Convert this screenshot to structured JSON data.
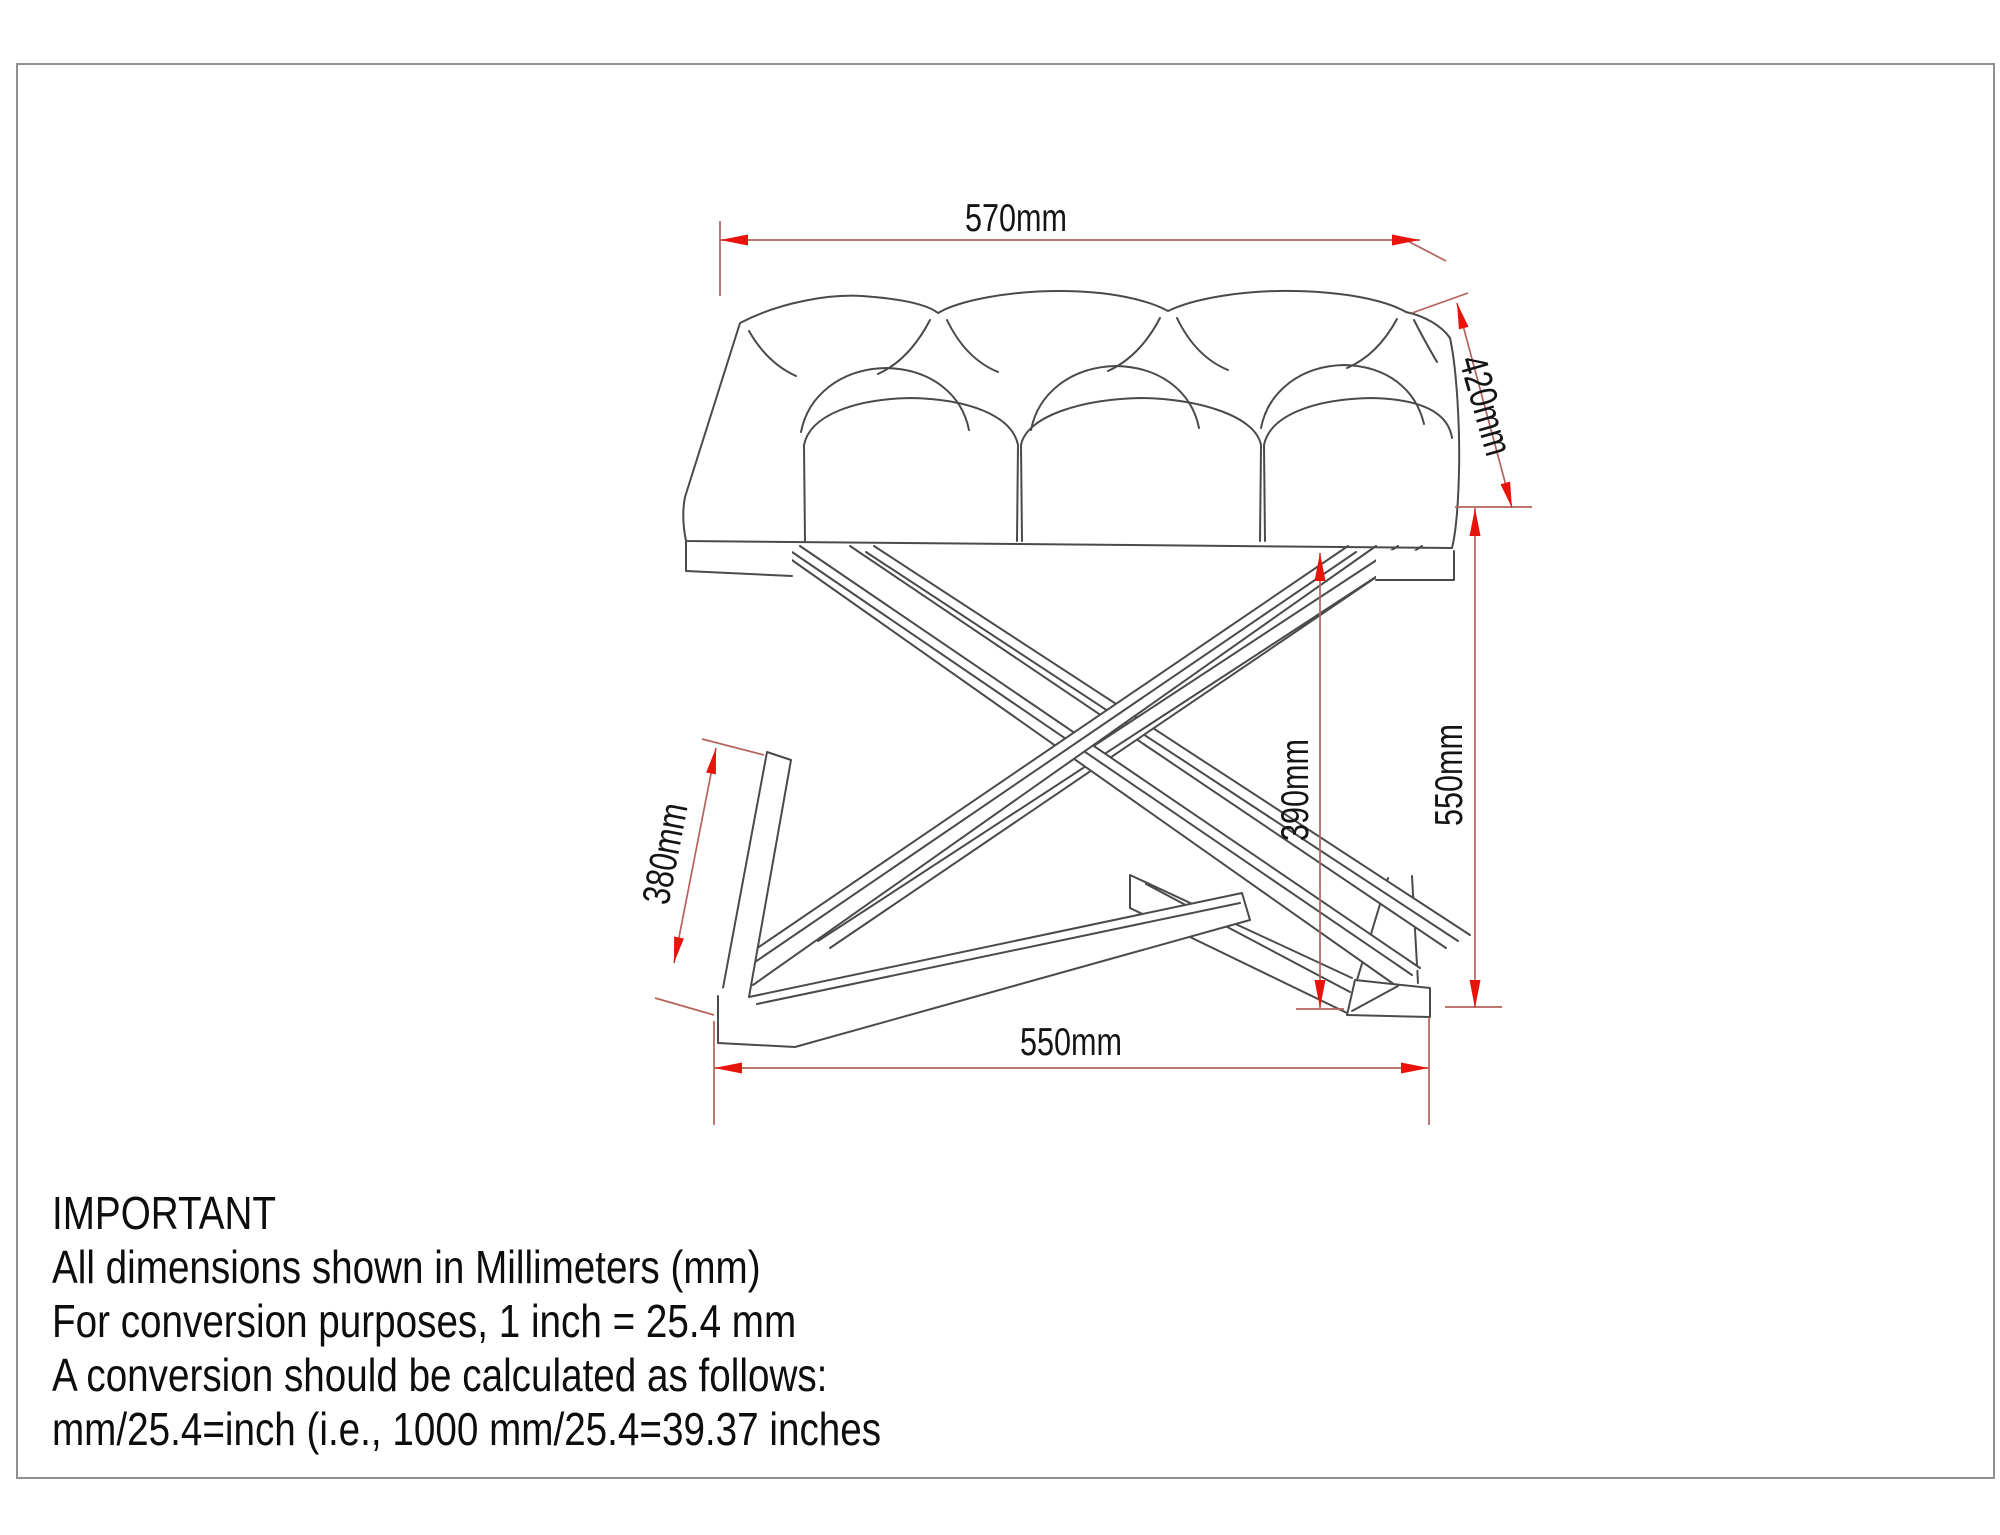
{
  "page": {
    "background": "#ffffff",
    "border_color": "#8f8f8f"
  },
  "drawing": {
    "description": "tufted-bench-with-x-base-technical-drawing",
    "line_color": "#4a4a4a",
    "dimension_line_color": "#b4625c",
    "arrow_color": "#e8140c",
    "dimensions": {
      "top_width": {
        "label": "570mm"
      },
      "depth": {
        "label": "420mm"
      },
      "overall_height": {
        "label": "550mm"
      },
      "inner_height": {
        "label": "390mm"
      },
      "foot_length": {
        "label": "380mm"
      },
      "base_width": {
        "label": "550mm"
      }
    }
  },
  "note": {
    "heading": "IMPORTANT",
    "lines": [
      "All dimensions shown in Millimeters (mm)",
      "For conversion purposes, 1 inch = 25.4 mm",
      "A conversion should be calculated as follows:",
      "mm/25.4=inch (i.e., 1000 mm/25.4=39.37 inches"
    ]
  }
}
